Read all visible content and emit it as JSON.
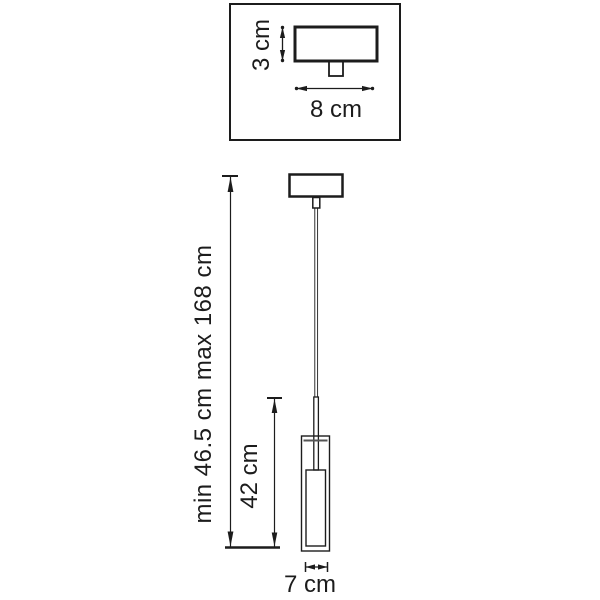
{
  "drawing": {
    "title": "pendant-lamp-dimension-drawing",
    "labels": {
      "canopy_height": "3 cm",
      "canopy_width": "8 cm",
      "overall_height": "min 46.5 cm max 168 cm",
      "shade_height": "42 cm",
      "shade_width": "7 cm"
    },
    "colors": {
      "line": "#1c1c1c",
      "background": "#ffffff"
    }
  }
}
